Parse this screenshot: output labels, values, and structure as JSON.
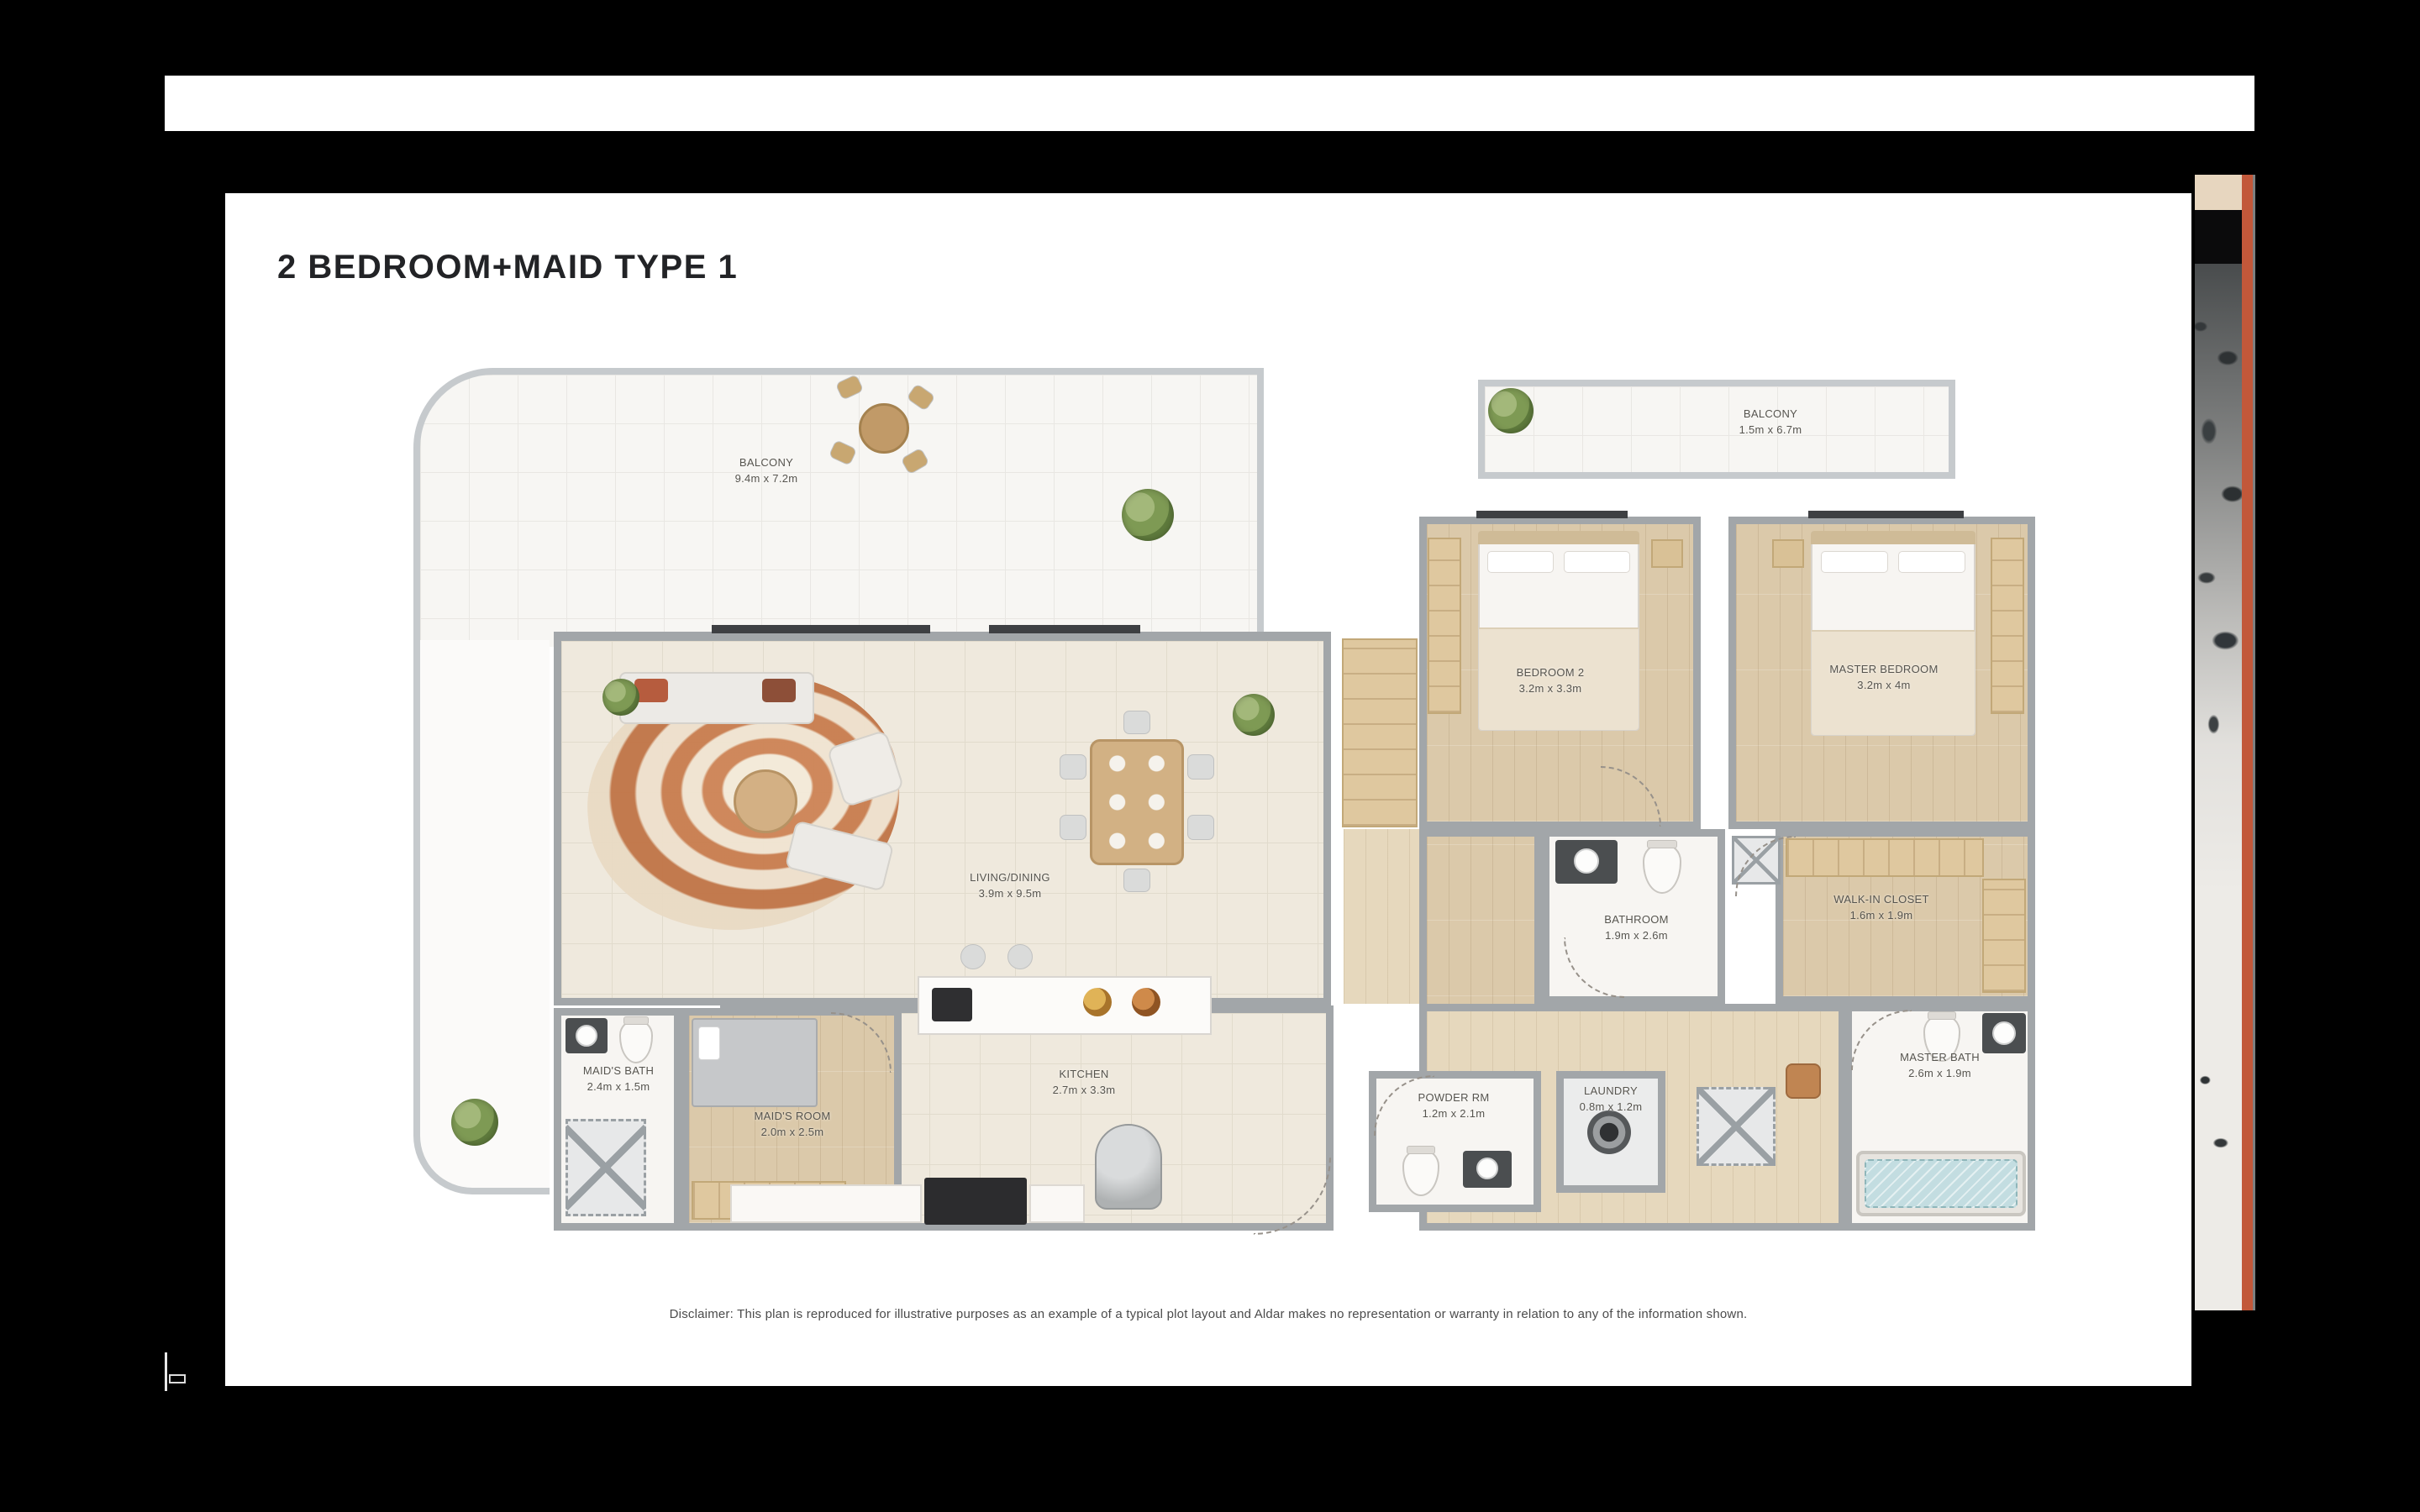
{
  "page": {
    "title": "2 BEDROOM+MAID TYPE 1",
    "disclaimer": "Disclaimer: This plan is reproduced for illustrative purposes as an example of a typical plot layout and Aldar makes no representation or warranty in relation to any of the information shown."
  },
  "colors": {
    "backdrop": "#000000",
    "page_bg": "#ffffff",
    "wall_gray": "#a2a6a9",
    "wood_floor": "#dbc9aa",
    "tile_cream": "#efe9dd",
    "label_text": "#56544e",
    "accent_orange": "#c2583a",
    "tub_water": "#c3dde1"
  },
  "rooms": [
    {
      "id": "balcony-main",
      "label": "BALCONY",
      "dims": "9.4m x 7.2m"
    },
    {
      "id": "balcony-right",
      "label": "BALCONY",
      "dims": "1.5m x 6.7m"
    },
    {
      "id": "living-dining",
      "label": "LIVING/DINING",
      "dims": "3.9m x 9.5m"
    },
    {
      "id": "kitchen",
      "label": "KITCHEN",
      "dims": "2.7m x 3.3m"
    },
    {
      "id": "maids-bath",
      "label": "MAID'S BATH",
      "dims": "2.4m x 1.5m"
    },
    {
      "id": "maids-room",
      "label": "MAID'S ROOM",
      "dims": "2.0m x 2.5m"
    },
    {
      "id": "bedroom-2",
      "label": "BEDROOM 2",
      "dims": "3.2m x 3.3m"
    },
    {
      "id": "master-bedroom",
      "label": "MASTER BEDROOM",
      "dims": "3.2m x 4m"
    },
    {
      "id": "bathroom",
      "label": "BATHROOM",
      "dims": "1.9m x 2.6m"
    },
    {
      "id": "walk-in-closet",
      "label": "WALK-IN CLOSET",
      "dims": "1.6m x 1.9m"
    },
    {
      "id": "powder-room",
      "label": "POWDER RM",
      "dims": "1.2m x 2.1m"
    },
    {
      "id": "laundry",
      "label": "LAUNDRY",
      "dims": "0.8m x 1.2m"
    },
    {
      "id": "master-bath",
      "label": "MASTER BATH",
      "dims": "2.6m x 1.9m"
    }
  ]
}
